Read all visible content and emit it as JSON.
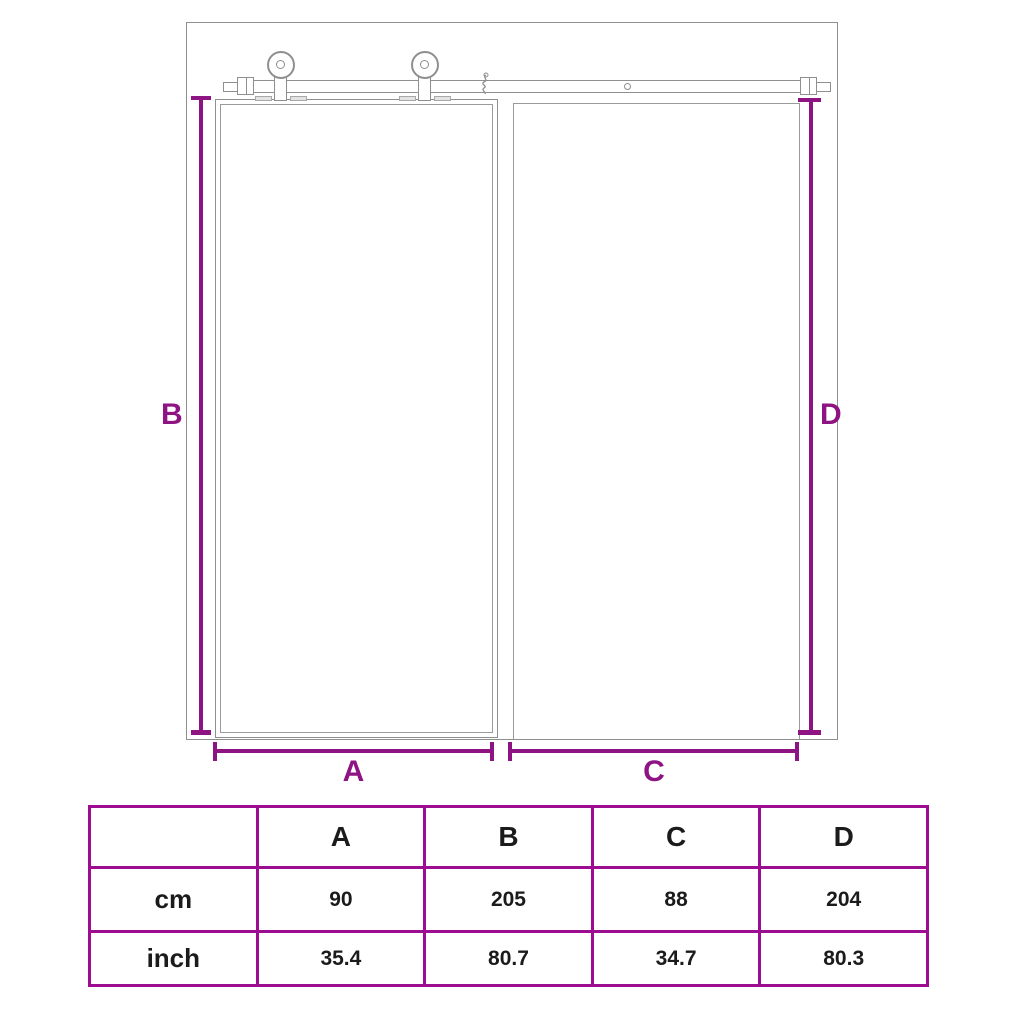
{
  "colors": {
    "dimension_accent": "#8E1383",
    "table_border": "#9C0D92",
    "drawing_line": "#8F8F8F",
    "text": "#1B1B1B"
  },
  "diagram": {
    "dim_labels": {
      "a": "A",
      "b": "B",
      "c": "C",
      "d": "D"
    }
  },
  "table": {
    "col_headers": [
      "A",
      "B",
      "C",
      "D"
    ],
    "rows": [
      {
        "label": "cm",
        "values": [
          "90",
          "205",
          "88",
          "204"
        ]
      },
      {
        "label": "inch",
        "values": [
          "35.4",
          "80.7",
          "34.7",
          "80.3"
        ]
      }
    ]
  }
}
